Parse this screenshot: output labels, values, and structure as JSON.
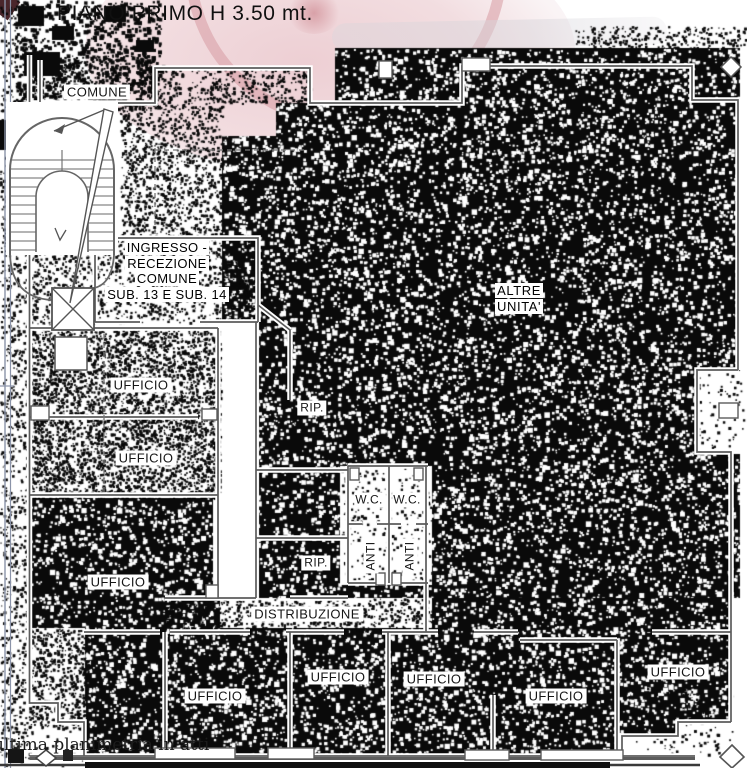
{
  "title": "PIANO PRIMO H 3.50 mt.",
  "footer_note": "ultima planimetria in atti",
  "labels": {
    "comune": "COMUNE",
    "ingresso": {
      "line1": "INGRESSO -",
      "line2": "RECEZIONE",
      "line3": "COMUNE",
      "line4": "SUB. 13 E SUB. 14"
    },
    "altre_unita": {
      "line1": "ALTRE",
      "line2": "UNITA'"
    },
    "distribuzione": "DISTRIBUZIONE",
    "rip1": "RIP.",
    "rip2": "RIP.",
    "wc1": "W.C.",
    "wc2": "W.C.",
    "anti1": "ANTI",
    "anti2": "ANTI",
    "offices_left": [
      "UFFICIO",
      "UFFICIO",
      "UFFICIO"
    ],
    "offices_bottom": [
      "UFFICIO",
      "UFFICIO",
      "UFFICIO",
      "UFFICIO",
      "UFFICIO"
    ]
  },
  "colors": {
    "wall_gray": "#5c5c5c",
    "frame_blue": "#8a93a8",
    "stamp_pink": "#ecccd1",
    "stamp_ring": "#d79ba3",
    "noise_black": "#0a0a0a"
  }
}
